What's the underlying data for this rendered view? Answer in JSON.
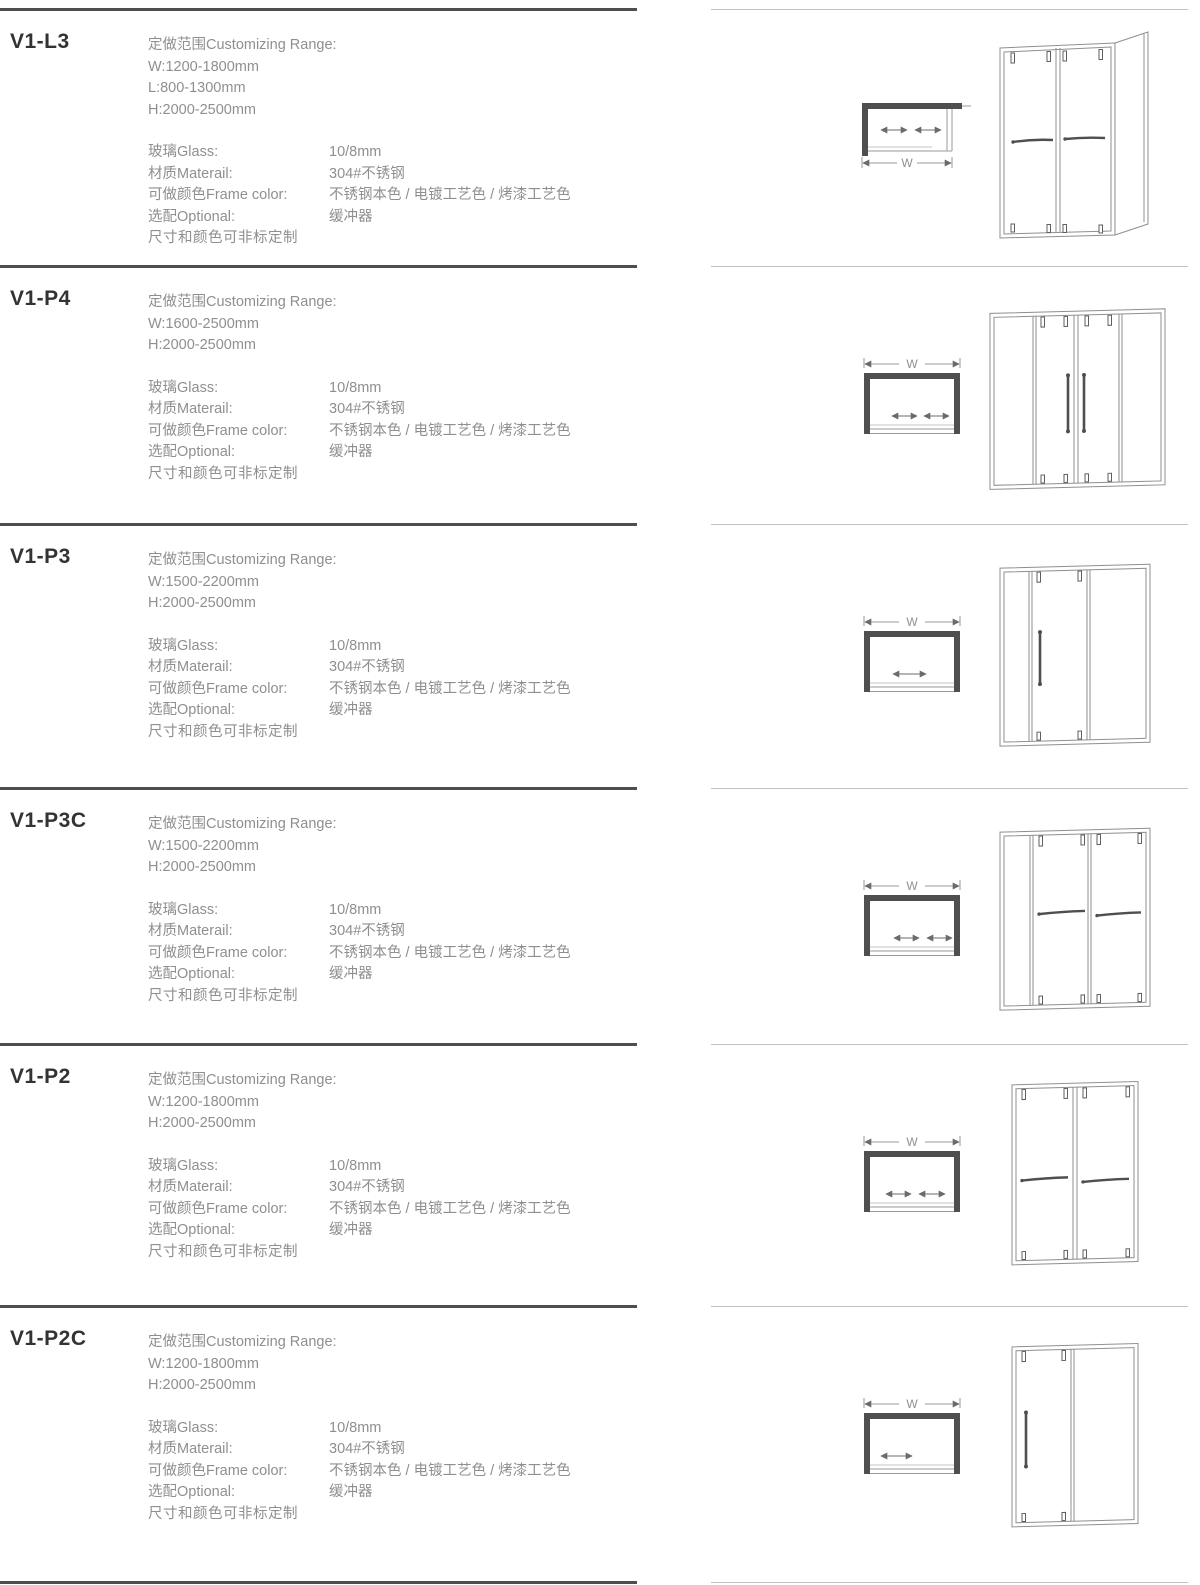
{
  "sections": [
    {
      "model": "V1-L3",
      "range_title": "定做范围Customizing Range:",
      "range_lines": [
        "W:1200-1800mm",
        "L:800-1300mm",
        "H:2000-2500mm"
      ],
      "specs": [
        {
          "label": "玻璃Glass:",
          "value": "10/8mm"
        },
        {
          "label": "材质Materail:",
          "value": "304#不锈钢"
        },
        {
          "label": "可做颜色Frame color:",
          "value": "不锈钢本色 / 电镀工艺色 / 烤漆工艺色"
        },
        {
          "label": "选配Optional:",
          "value": "缓冲器"
        }
      ],
      "note": "尺寸和颜色可非标定制",
      "drawing": {
        "w_label": "W",
        "plan": "top-view-w-below-two-arrows-left-wall",
        "front": "front-view-2-sliding-doors-with-return-panel"
      }
    },
    {
      "model": "V1-P4",
      "range_title": "定做范围Customizing Range:",
      "range_lines": [
        "W:1600-2500mm",
        "H:2000-2500mm"
      ],
      "specs": [
        {
          "label": "玻璃Glass:",
          "value": "10/8mm"
        },
        {
          "label": "材质Materail:",
          "value": "304#不锈钢"
        },
        {
          "label": "可做颜色Frame color:",
          "value": "不锈钢本色 / 电镀工艺色 / 烤漆工艺色"
        },
        {
          "label": "选配Optional:",
          "value": "缓冲器"
        }
      ],
      "note": "尺寸和颜色可非标定制",
      "drawing": {
        "w_label": "W",
        "plan": "top-view-w-above-two-center-arrows",
        "front": "front-view-4-panel-center-opening-vertical-handles"
      }
    },
    {
      "model": "V1-P3",
      "range_title": "定做范围Customizing Range:",
      "range_lines": [
        "W:1500-2200mm",
        "H:2000-2500mm"
      ],
      "specs": [
        {
          "label": "玻璃Glass:",
          "value": "10/8mm"
        },
        {
          "label": "材质Materail:",
          "value": "304#不锈钢"
        },
        {
          "label": "可做颜色Frame color:",
          "value": "不锈钢本色 / 电镀工艺色 / 烤漆工艺色"
        },
        {
          "label": "选配Optional:",
          "value": "缓冲器"
        }
      ],
      "note": "尺寸和颜色可非标定制",
      "drawing": {
        "w_label": "W",
        "plan": "top-view-w-above-one-arrow",
        "front": "front-view-3-panel-single-slider-vertical-handle"
      }
    },
    {
      "model": "V1-P3C",
      "range_title": "定做范围Customizing Range:",
      "range_lines": [
        "W:1500-2200mm",
        "H:2000-2500mm"
      ],
      "specs": [
        {
          "label": "玻璃Glass:",
          "value": "10/8mm"
        },
        {
          "label": "材质Materail:",
          "value": "304#不锈钢"
        },
        {
          "label": "可做颜色Frame color:",
          "value": "不锈钢本色 / 电镀工艺色 / 烤漆工艺色"
        },
        {
          "label": "选配Optional:",
          "value": "缓冲器"
        }
      ],
      "note": "尺寸和颜色可非标定制",
      "drawing": {
        "w_label": "W",
        "plan": "top-view-w-above-two-arrows",
        "front": "front-view-3-panel-two-sliders-towel-bars"
      }
    },
    {
      "model": "V1-P2",
      "range_title": "定做范围Customizing Range:",
      "range_lines": [
        "W:1200-1800mm",
        "H:2000-2500mm"
      ],
      "specs": [
        {
          "label": "玻璃Glass:",
          "value": "10/8mm"
        },
        {
          "label": "材质Materail:",
          "value": "304#不锈钢"
        },
        {
          "label": "可做颜色Frame color:",
          "value": "不锈钢本色 / 电镀工艺色 / 烤漆工艺色"
        },
        {
          "label": "选配Optional:",
          "value": "缓冲器"
        }
      ],
      "note": "尺寸和颜色可非标定制",
      "drawing": {
        "w_label": "W",
        "plan": "top-view-w-above-two-arrows",
        "front": "front-view-2-panel-two-sliders-towel-bars"
      }
    },
    {
      "model": "V1-P2C",
      "range_title": "定做范围Customizing Range:",
      "range_lines": [
        "W:1200-1800mm",
        "H:2000-2500mm"
      ],
      "specs": [
        {
          "label": "玻璃Glass:",
          "value": "10/8mm"
        },
        {
          "label": "材质Materail:",
          "value": "304#不锈钢"
        },
        {
          "label": "可做颜色Frame color:",
          "value": "不锈钢本色 / 电镀工艺色 / 烤漆工艺色"
        },
        {
          "label": "选配Optional:",
          "value": "缓冲器"
        }
      ],
      "note": "尺寸和颜色可非标定制",
      "drawing": {
        "w_label": "W",
        "plan": "top-view-w-above-one-arrow",
        "front": "front-view-2-panel-single-slider-vertical-handle"
      }
    }
  ]
}
